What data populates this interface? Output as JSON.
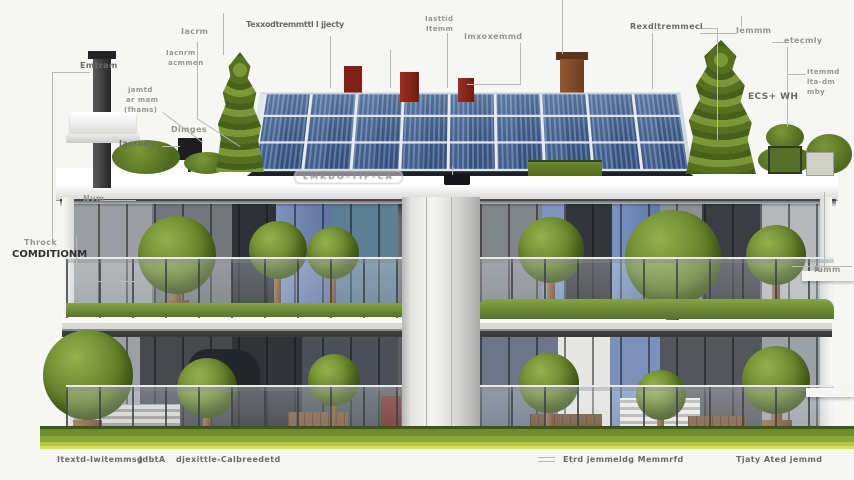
{
  "title": "Green energy condominium infographic",
  "palette": {
    "background": "#f6f6f4",
    "solar_panel_blue": "#42608e",
    "leaf_green": "#5f7d26",
    "grass_green": "#7c9a34",
    "grass_highlight": "#d7e05a",
    "concrete_gray": "#dededa",
    "wood_brown": "#8a5f3c",
    "chimney_red": "#8b2717",
    "label_gray": "#96968f",
    "label_dark": "#2e2e2c",
    "leader_line": "#b8b8b6"
  },
  "labels": {
    "pole": "Emtram",
    "left_a": "Iacrm",
    "left_b1": "Iacnrm",
    "left_b2": "acmmen",
    "roof_long": "Texxodtremmttl I jjecty",
    "mid_1": "jamtd",
    "mid_2": "ar mam",
    "mid_3": "(fhams)",
    "iacrndy": "Iacrndy",
    "dimges": "Dimges",
    "nym": "Nym",
    "person_1": "Throck",
    "person_2": "COMDITIONM",
    "top_center_1": "Iasttid",
    "top_center_2": "Itemm",
    "top_center_wide": "Imxoxemmd",
    "top_right_a": "Rexdltremmecl",
    "top_right_b": "Iemmm",
    "top_right_c": "etecmly",
    "right_1": "Itemmd",
    "right_2": "lta-dm",
    "right_3": "mby",
    "ecs": "ECS+ WH",
    "lumm": "lumm",
    "solar_caption": "LMKDO–TIF–CA",
    "bottom_1": "Itextd-Iwitemmsg",
    "bottom_2": "JdbtA",
    "bottom_3": "djexittle-Calbreedetd",
    "bottom_4": "Etrd jemmeldg Memmrfd",
    "bottom_5": "Tjaty Ated jemmd"
  }
}
